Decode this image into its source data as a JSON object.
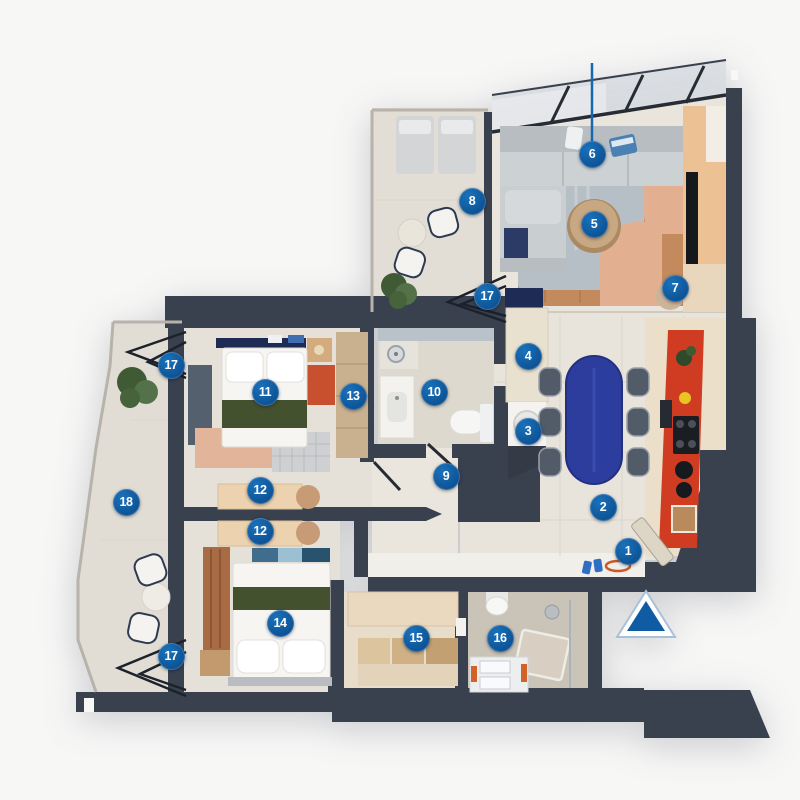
{
  "plan": {
    "type": "apartment-floor-plan-3d-top-view",
    "units_shown": "none",
    "room_labels_shown": "none"
  },
  "palette": {
    "background": "#f7f7f6",
    "wall": "#39404e",
    "floor": "#e8e3da",
    "floor_bath": "#ded9ce",
    "floor_bath2": "#cac3b7",
    "terrace": "#e1ddd4",
    "wood_rug": "#c28a5d",
    "kitchen_red": "#cf3c22",
    "dining_table_blue": "#2c3d9e",
    "bed_green": "#44512e",
    "marker_blue": "#0f5ca4",
    "leader_blue": "#1668ad"
  },
  "markers": [
    {
      "n": "1",
      "x": 628,
      "y": 551
    },
    {
      "n": "2",
      "x": 603,
      "y": 507
    },
    {
      "n": "3",
      "x": 528,
      "y": 431
    },
    {
      "n": "4",
      "x": 528,
      "y": 356
    },
    {
      "n": "5",
      "x": 594,
      "y": 224
    },
    {
      "n": "6",
      "x": 592,
      "y": 154
    },
    {
      "n": "7",
      "x": 675,
      "y": 288
    },
    {
      "n": "8",
      "x": 472,
      "y": 201
    },
    {
      "n": "9",
      "x": 446,
      "y": 476
    },
    {
      "n": "10",
      "x": 434,
      "y": 392
    },
    {
      "n": "11",
      "x": 265,
      "y": 392
    },
    {
      "n": "12",
      "x": 260,
      "y": 490
    },
    {
      "n": "12",
      "x": 260,
      "y": 531
    },
    {
      "n": "13",
      "x": 353,
      "y": 396
    },
    {
      "n": "14",
      "x": 280,
      "y": 623
    },
    {
      "n": "15",
      "x": 416,
      "y": 638
    },
    {
      "n": "16",
      "x": 500,
      "y": 638
    },
    {
      "n": "17",
      "x": 171,
      "y": 365
    },
    {
      "n": "17",
      "x": 487,
      "y": 296
    },
    {
      "n": "17",
      "x": 171,
      "y": 656
    },
    {
      "n": "18",
      "x": 126,
      "y": 502
    }
  ],
  "north_arrow": {
    "x": 646,
    "y": 614
  },
  "marker6_leader": {
    "x": 592,
    "y_top": 63,
    "y_bottom": 142
  }
}
